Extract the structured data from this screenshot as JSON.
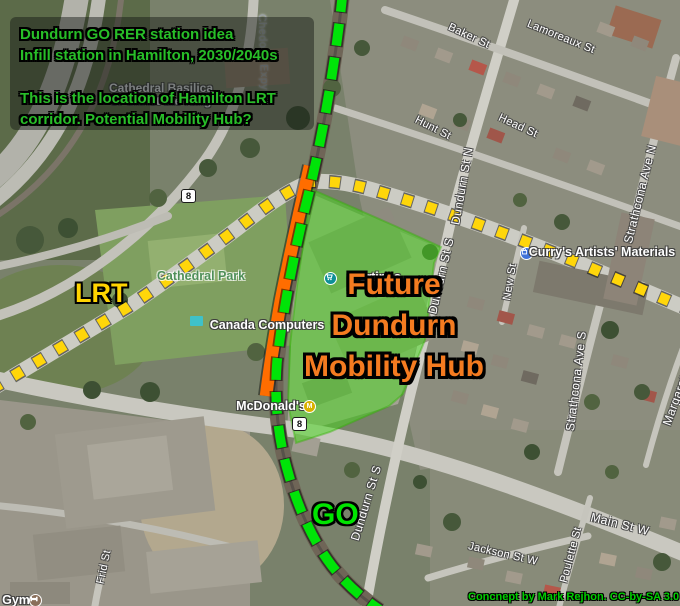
{
  "annotations": {
    "title_box": {
      "line1": "Dundurn GO RER station idea",
      "line2": "Infill station in Hamilton, 2030/2040s",
      "line3": "This is the location of Hamilton LRT",
      "line4": "corridor. Potential Mobility Hub?"
    },
    "lrt_label": "LRT",
    "go_label": "GO",
    "hub_label": {
      "line1": "Future",
      "line2": "Dundurn",
      "line3": "Mobility Hub"
    },
    "credit": "Concnept by Mark Rejhon. CC-by-SA 3.0",
    "colors": {
      "title_text": "#28be28",
      "lrt_line": "#ffd60a",
      "go_line": "#00e408",
      "station_platform": "#ff6d00",
      "hub_area": "#46d81c",
      "hub_text": "#f47b20"
    }
  },
  "map_labels": {
    "streets": {
      "baker": "Baker St",
      "lamoreaux": "Lamoreaux St",
      "hunt": "Hunt St",
      "head": "Head St",
      "dundurn_n": "Dundurn St N",
      "dundurn_s_upper": "Dundurn St S",
      "dundurn_s_lower": "Dundurn St S",
      "new": "New St",
      "strathcona_n": "Strathcona Ave N",
      "strathcona_s": "Strathcona Ave S",
      "margaret": "Margaret St",
      "main": "Main St W",
      "jackson": "Jackson St W",
      "poulette": "Poulette St",
      "frid": "Frid St",
      "chedoke": "Chedoke Expy"
    },
    "pois": {
      "cathedral_basilica_line1": "Cathedral Basilica",
      "cathedral_basilica_line2": "of Christ the King",
      "cathedral_park": "Cathedral Park",
      "canada_computers": "Canada Computers",
      "fortinos": "Fortinos",
      "mcdonalds": "McDonald's",
      "currys": "Curry's Artists' Materials",
      "gym": "Gym"
    },
    "highway_shields": [
      "8",
      "8"
    ]
  }
}
